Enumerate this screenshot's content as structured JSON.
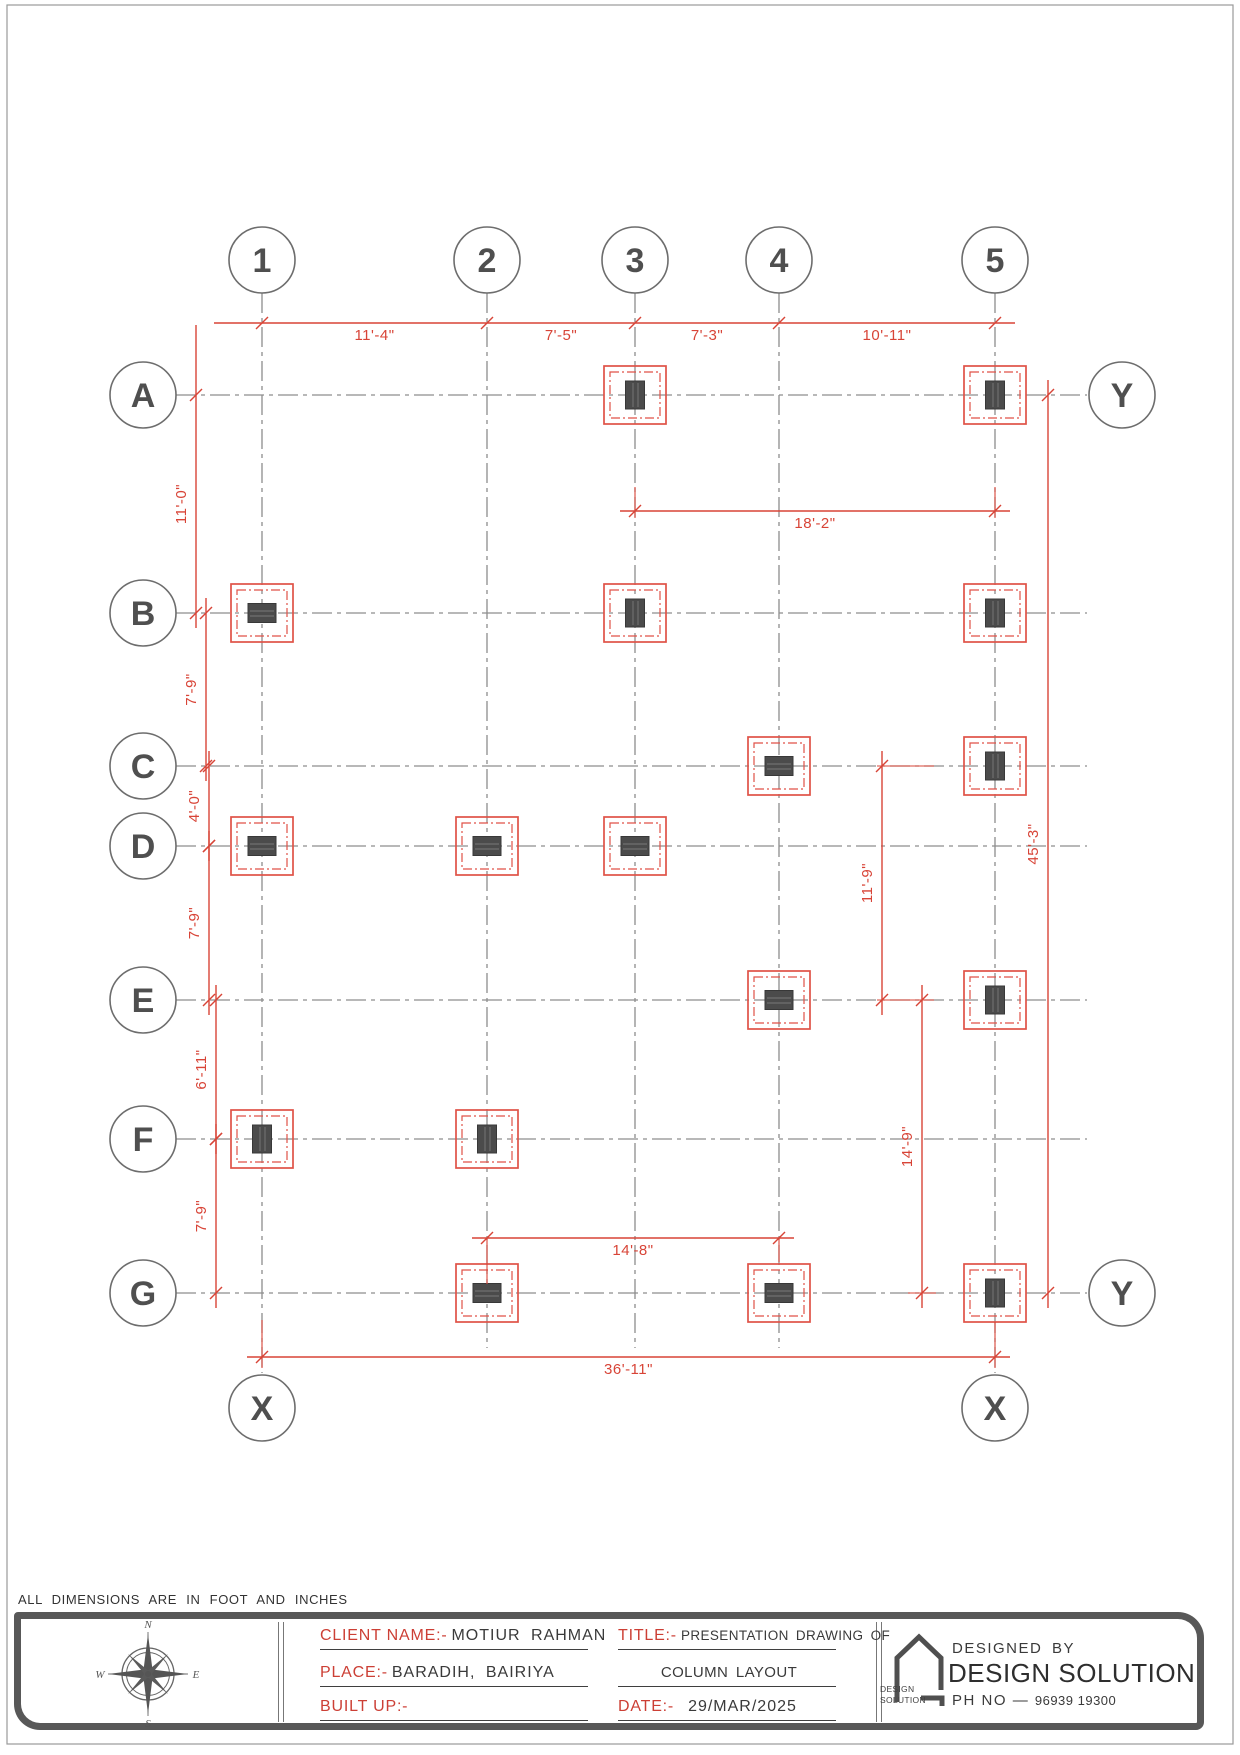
{
  "sheet": {
    "width": 1240,
    "height": 1755,
    "note": "ALL DIMENSIONS ARE IN FOOT AND INCHES"
  },
  "colors": {
    "red": "#d84437",
    "column_fill": "#4b4b4b",
    "grid_gray": "#8d8d8d",
    "bubble_gray": "#6d6d6d",
    "text_dark": "#3a3a3a",
    "block_border": "#585858"
  },
  "grid": {
    "columns": [
      {
        "id": "1",
        "x": 262
      },
      {
        "id": "2",
        "x": 487
      },
      {
        "id": "3",
        "x": 635
      },
      {
        "id": "4",
        "x": 779
      },
      {
        "id": "5",
        "x": 995
      }
    ],
    "rows": [
      {
        "id": "A",
        "y": 395
      },
      {
        "id": "B",
        "y": 613
      },
      {
        "id": "C",
        "y": 766
      },
      {
        "id": "D",
        "y": 846
      },
      {
        "id": "E",
        "y": 1000
      },
      {
        "id": "F",
        "y": 1139
      },
      {
        "id": "G",
        "y": 1293
      }
    ],
    "bubble_radius": 33,
    "top_bubble_cy": 260,
    "left_bubble_cx": 143,
    "col_line_end": 1348,
    "col_line_end_long": 1373,
    "row_line_end": 1087,
    "x_markers": {
      "label": "X",
      "cy": 1408,
      "at_columns": [
        "1",
        "5"
      ]
    },
    "y_markers": {
      "label": "Y",
      "cx": 1122,
      "at_rows": [
        "A",
        "G"
      ]
    }
  },
  "footings": {
    "outer_w": 62,
    "outer_h": 58,
    "inner_inset": 6,
    "col_long": 28,
    "col_short": 19,
    "items": [
      {
        "at": "A3",
        "orient": "v"
      },
      {
        "at": "A5",
        "orient": "v"
      },
      {
        "at": "B1",
        "orient": "h"
      },
      {
        "at": "B3",
        "orient": "v"
      },
      {
        "at": "B5",
        "orient": "v"
      },
      {
        "at": "C4",
        "orient": "h"
      },
      {
        "at": "C5",
        "orient": "v"
      },
      {
        "at": "D1",
        "orient": "h"
      },
      {
        "at": "D2",
        "orient": "h"
      },
      {
        "at": "D3",
        "orient": "h"
      },
      {
        "at": "E4",
        "orient": "h"
      },
      {
        "at": "E5",
        "orient": "v"
      },
      {
        "at": "F1",
        "orient": "v"
      },
      {
        "at": "F2",
        "orient": "v"
      },
      {
        "at": "G2",
        "orient": "h"
      },
      {
        "at": "G4",
        "orient": "h"
      },
      {
        "at": "G5",
        "orient": "v"
      }
    ]
  },
  "dimensions": {
    "horizontal": [
      {
        "y": 323,
        "between_columns": [
          "1",
          "2",
          "3",
          "4",
          "5"
        ],
        "labels": [
          "11'-4\"",
          "7'-5\"",
          "7'-3\"",
          "10'-11\""
        ],
        "ext_left": 48,
        "ext_right": 20
      },
      {
        "y": 511,
        "between_columns": [
          "3",
          "5"
        ],
        "labels": [
          "18'-2\""
        ]
      },
      {
        "y": 1238,
        "between_columns": [
          "2",
          "4"
        ],
        "labels": [
          "14'-8\""
        ]
      },
      {
        "y": 1357,
        "between_columns": [
          "1",
          "5"
        ],
        "labels": [
          "36'-11\""
        ]
      }
    ],
    "vertical": [
      {
        "x": 196,
        "between_rows": [
          "A",
          "B"
        ],
        "labels": [
          "11'-0\""
        ],
        "ext_top": 70
      },
      {
        "x": 206,
        "between_rows": [
          "B",
          "C"
        ],
        "labels": [
          "7'-9\""
        ]
      },
      {
        "x": 209,
        "between_rows": [
          "C",
          "D"
        ],
        "labels": [
          "4'-0\""
        ]
      },
      {
        "x": 209,
        "between_rows": [
          "D",
          "E"
        ],
        "labels": [
          "7'-9\""
        ]
      },
      {
        "x": 216,
        "between_rows": [
          "E",
          "F"
        ],
        "labels": [
          "6'-11\""
        ]
      },
      {
        "x": 216,
        "between_rows": [
          "F",
          "G"
        ],
        "labels": [
          "7'-9\""
        ]
      },
      {
        "x": 882,
        "between_rows": [
          "C",
          "E"
        ],
        "labels": [
          "11'-9\""
        ]
      },
      {
        "x": 922,
        "between_rows": [
          "E",
          "G"
        ],
        "labels": [
          "14'-9\""
        ]
      },
      {
        "x": 1048,
        "between_rows": [
          "A",
          "G"
        ],
        "labels": [
          "45'-3\""
        ]
      }
    ],
    "extension_lines": [
      [
        635,
        487,
        635,
        518
      ],
      [
        995,
        487,
        995,
        518
      ],
      [
        877,
        766,
        934,
        766
      ],
      [
        877,
        1000,
        934,
        1000
      ],
      [
        908,
        1293,
        936,
        1293
      ],
      [
        487,
        1238,
        487,
        1284
      ],
      [
        779,
        1238,
        779,
        1262
      ],
      [
        262,
        1320,
        262,
        1368
      ],
      [
        995,
        1322,
        995,
        1368
      ]
    ]
  },
  "title_block": {
    "client_label": "CLIENT NAME:-",
    "client_value": "MOTIUR RAHMAN",
    "place_label": "PLACE:-",
    "place_value": "BARADIH, BAIRIYA",
    "built_label": "BUILT UP:-",
    "built_value": "",
    "title_label": "TITLE:-",
    "title_value": "PRESENTATION DRAWING OF",
    "title_value2": "COLUMN LAYOUT",
    "date_label": "DATE:-",
    "date_value": "29/MAR/2025",
    "designed_by": "DESIGNED BY",
    "brand": "DESIGN SOLUTION",
    "ph_label": "PH NO",
    "ph_sep": "—",
    "phone": "96939 19300",
    "logo_text1": "DESIGN",
    "logo_text2": "SOLUTION",
    "compass": {
      "n": "N",
      "e": "E",
      "s": "S",
      "w": "W"
    }
  }
}
